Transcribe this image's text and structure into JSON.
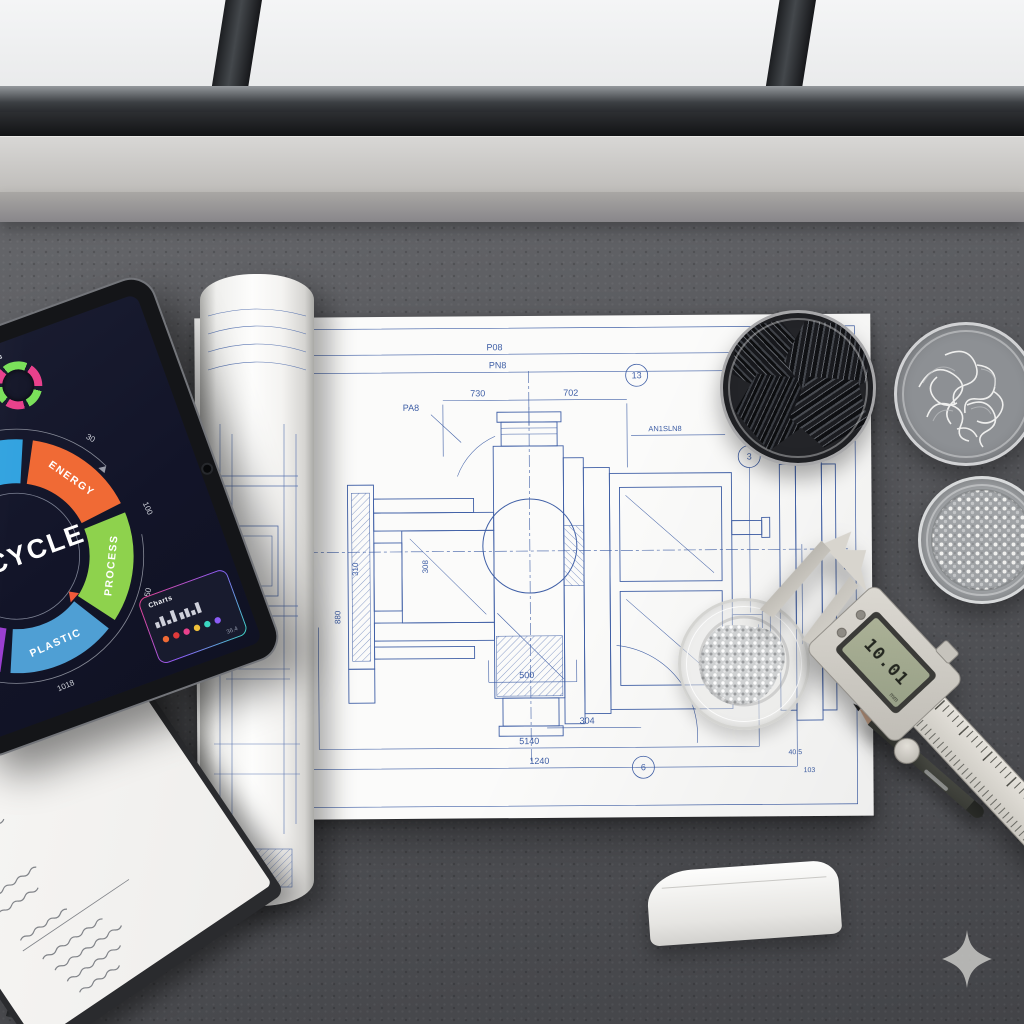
{
  "tablet": {
    "mini_ring": {
      "label": "Charts"
    },
    "wheel": {
      "center_label": "RECYCLE",
      "segments": [
        {
          "label": "REUSE",
          "color": "#6fd9a0"
        },
        {
          "label": "RECYCLE",
          "color": "#33a3e0"
        },
        {
          "label": "ENERGY",
          "color": "#f06a35"
        },
        {
          "label": "PROCESS",
          "color": "#8ed24d"
        },
        {
          "label": "PLASTIC",
          "color": "#4f9fd4"
        },
        {
          "label": "SORT",
          "color": "#9b3fd1"
        }
      ],
      "arc_labels": [
        "MIN",
        "30",
        "100",
        "150",
        "700",
        "1018"
      ]
    },
    "stats_card": {
      "title": "Charts",
      "footer": "36.4",
      "dots": [
        "#f06a35",
        "#e03a3a",
        "#e8418c",
        "#f0c03a",
        "#3ad6c0",
        "#8b5cf6"
      ]
    }
  },
  "blueprint": {
    "ink_color": "#3f5fa6",
    "dims": [
      "P08",
      "PN8",
      "730",
      "702",
      "PA8",
      "AN1SLN8",
      "500",
      "304",
      "5140",
      "1240",
      "310",
      "308",
      "880",
      "101",
      "120",
      "40.5",
      "103"
    ],
    "callouts": [
      "13",
      "3",
      "6"
    ]
  },
  "caliper": {
    "display": "10.01",
    "unit": "mm"
  }
}
